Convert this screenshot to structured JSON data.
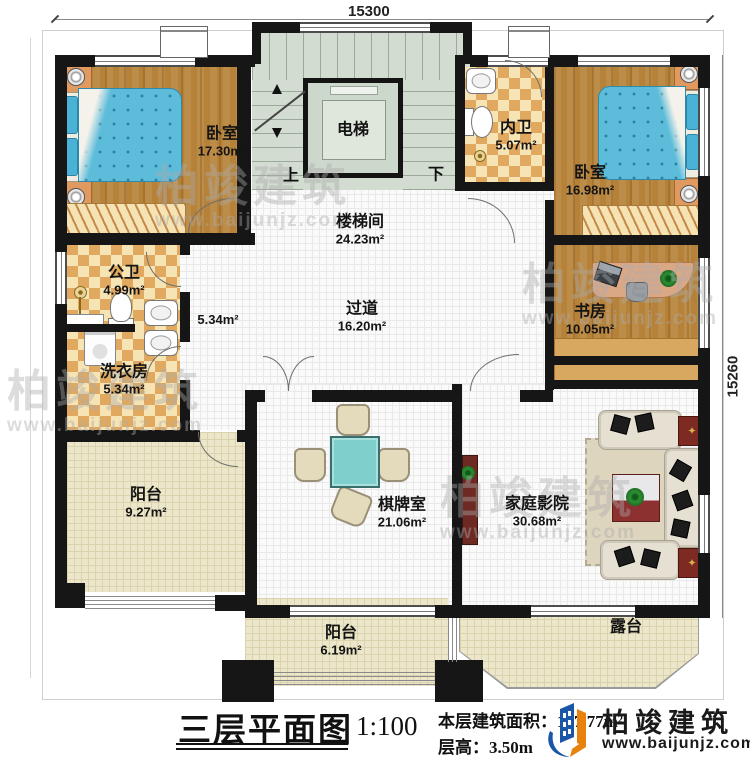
{
  "dimensions": {
    "width": "15300",
    "height": "15260"
  },
  "stairs": {
    "up": "上",
    "down": "下"
  },
  "rooms": [
    {
      "id": "bedroom-left",
      "name": "卧室",
      "area": "17.30m²"
    },
    {
      "id": "elevator",
      "name": "电梯",
      "area": ""
    },
    {
      "id": "inner-bath",
      "name": "内卫",
      "area": "5.07m²"
    },
    {
      "id": "bedroom-right",
      "name": "卧室",
      "area": "16.98m²"
    },
    {
      "id": "stairwell",
      "name": "楼梯间",
      "area": "24.23m²"
    },
    {
      "id": "corridor",
      "name": "",
      "area": "5.34m²"
    },
    {
      "id": "public-bath",
      "name": "公卫",
      "area": "4.99m²"
    },
    {
      "id": "laundry",
      "name": "洗衣房",
      "area": "5.34m²"
    },
    {
      "id": "hallway",
      "name": "过道",
      "area": "16.20m²"
    },
    {
      "id": "study",
      "name": "书房",
      "area": "10.05m²"
    },
    {
      "id": "balcony-left",
      "name": "阳台",
      "area": "9.27m²"
    },
    {
      "id": "game-room",
      "name": "棋牌室",
      "area": "21.06m²"
    },
    {
      "id": "home-theater",
      "name": "家庭影院",
      "area": "30.68m²"
    },
    {
      "id": "balcony-bottom",
      "name": "阳台",
      "area": "6.19m²"
    },
    {
      "id": "terrace",
      "name": "露台",
      "area": ""
    }
  ],
  "title_block": {
    "title": "三层平面图",
    "scale": "1:100",
    "area_label": "本层建筑面积：",
    "area_value": "197.77m²",
    "floor_height_label": "层高：",
    "floor_height_value": "3.50m"
  },
  "brand": {
    "name": "柏竣建筑",
    "website": "www.baijunjz.com"
  },
  "watermark": {
    "name": "柏竣建筑",
    "website": "www.baijunjz.com"
  },
  "colors": {
    "wall": "#161616",
    "wood_floor": "#b6823a",
    "checker": "#e0a95f",
    "stairs": "#d3dcd1",
    "cream": "#ece6ca",
    "bed": "#5cbcda",
    "logo_blue": "#1a56a8",
    "logo_orange": "#e8820c"
  }
}
